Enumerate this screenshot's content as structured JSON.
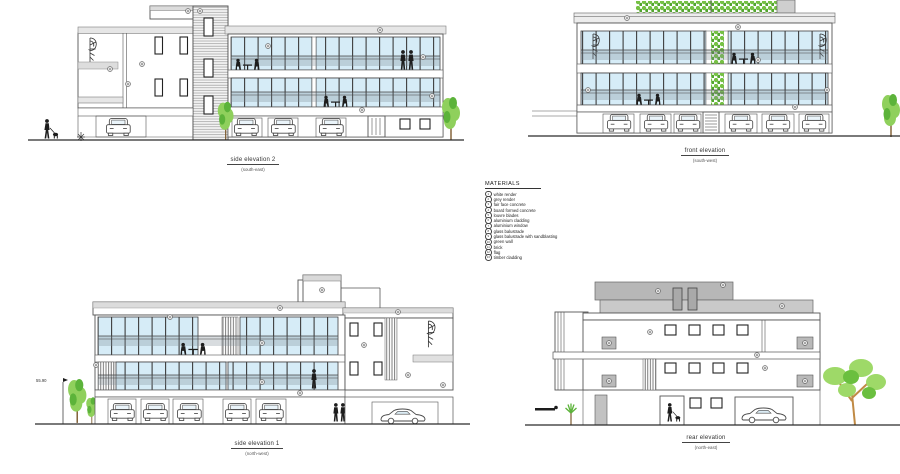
{
  "sheet": {
    "title": "building elevations drawing sheet"
  },
  "elevations": {
    "side2": {
      "title": "side elevation 2",
      "subtitle": "(south-east)"
    },
    "front": {
      "title": "front elevation",
      "subtitle": "(south-west)"
    },
    "side1": {
      "title": "side elevation 1",
      "subtitle": "(north-west)"
    },
    "rear": {
      "title": "rear elevation",
      "subtitle": "(north-east)"
    }
  },
  "materials": {
    "title": "MATERIALS",
    "items": [
      {
        "num": "1",
        "label": "white render"
      },
      {
        "num": "2",
        "label": "grey render"
      },
      {
        "num": "3",
        "label": "fair face concrete"
      },
      {
        "num": "4",
        "label": "board formed concrete"
      },
      {
        "num": "5",
        "label": "louvre blades"
      },
      {
        "num": "6",
        "label": "aluminium cladding"
      },
      {
        "num": "7",
        "label": "aluminium window"
      },
      {
        "num": "8",
        "label": "glass balustrade"
      },
      {
        "num": "9",
        "label": "glass balustrade with sandblasting"
      },
      {
        "num": "10",
        "label": "green wall"
      },
      {
        "num": "11",
        "label": "brick"
      },
      {
        "num": "12",
        "label": "flag"
      },
      {
        "num": "13",
        "label": "timber cladding"
      }
    ]
  },
  "annotations": {
    "level_marker": "55.90"
  },
  "colors": {
    "glazing_blue": "#d6ecf7",
    "band_grey": "#e6e6e6",
    "roof_slab_grey": "#b7b7b7",
    "foliage_green": "#8fd05c",
    "foliage_dark_green": "#5cb33a",
    "trunk_brown": "#c08a45",
    "silhouette_black": "#1d1d1d",
    "line_grey": "#4a4a4a"
  }
}
